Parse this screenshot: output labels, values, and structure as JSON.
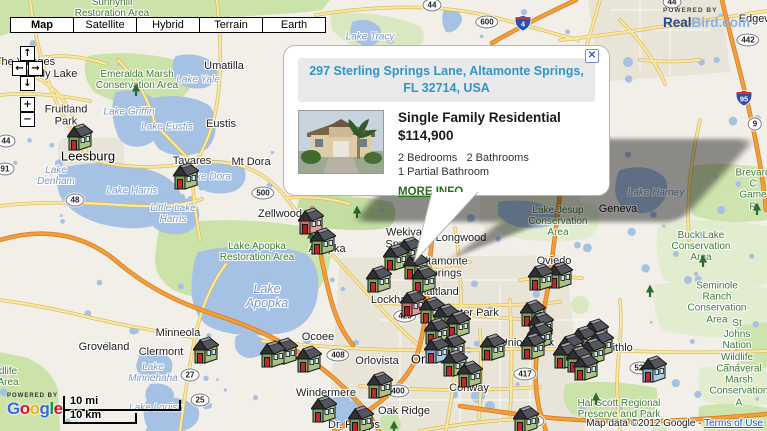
{
  "map_type_bar": {
    "buttons": [
      {
        "label": "Map",
        "active": true
      },
      {
        "label": "Satellite",
        "active": false
      },
      {
        "label": "Hybrid",
        "active": false
      },
      {
        "label": "Terrain",
        "active": false
      },
      {
        "label": "Earth",
        "active": false
      }
    ]
  },
  "pan_zoom": {
    "up": "↑",
    "left": "←",
    "right": "→",
    "down": "↓",
    "zoom_in": "+",
    "zoom_out": "−"
  },
  "branding_realbird": {
    "powered_by": "POWERED BY",
    "name_primary": "Real",
    "name_secondary": "Bird.com"
  },
  "branding_google": {
    "powered_by": "POWERED BY",
    "letters": [
      {
        "ch": "G",
        "color": "#3369e8"
      },
      {
        "ch": "o",
        "color": "#d50f25"
      },
      {
        "ch": "o",
        "color": "#eeb211"
      },
      {
        "ch": "g",
        "color": "#3369e8"
      },
      {
        "ch": "l",
        "color": "#009925"
      },
      {
        "ch": "e",
        "color": "#d50f25"
      }
    ]
  },
  "scale_bar": {
    "miles": "10 mi",
    "km": "10 km"
  },
  "attribution": {
    "text": "Map data ©2012 Google - ",
    "link": "Terms of Use"
  },
  "info_window": {
    "address": "297 Sterling Springs Lane, Altamonte Springs,\nFL 32714, USA",
    "property_type": "Single Family Residential",
    "price": "$114,900",
    "beds": "2 Bedrooms",
    "baths": "2 Bathrooms",
    "partial": "1 Partial Bathroom",
    "more_info": "MORE INFO",
    "close": "✕"
  },
  "colors": {
    "address": "#3096c7",
    "more_info": "#2d6e1f",
    "link": "#1155cc",
    "realbird_primary": "#24479c",
    "realbird_secondary": "#8ab0e0",
    "water": "#a5c1e3",
    "park": "#cbe2a8",
    "road_orange": "#f49d3b",
    "road_yellow": "#f8e9a2"
  },
  "marker_styles": {
    "g": {
      "front": "#7ea357",
      "side": "#a8c483",
      "roofA": "#2f2f35",
      "roofB": "#55555e",
      "door": "#c1272d"
    },
    "p": {
      "front": "#c96d6d",
      "side": "#e49c9c",
      "roofA": "#2f2f35",
      "roofB": "#55555e",
      "door": "#a31d1d"
    },
    "b": {
      "front": "#7fa9cb",
      "side": "#abcde4",
      "roofA": "#2f2f35",
      "roofB": "#55555e",
      "door": "#c1272d"
    }
  },
  "markers": [
    {
      "x": 80,
      "y": 137,
      "c": "g"
    },
    {
      "x": 186,
      "y": 176,
      "c": "g"
    },
    {
      "x": 311,
      "y": 221,
      "c": "p"
    },
    {
      "x": 323,
      "y": 241,
      "c": "g"
    },
    {
      "x": 396,
      "y": 257,
      "c": "g"
    },
    {
      "x": 410,
      "y": 250,
      "c": "g"
    },
    {
      "x": 379,
      "y": 279,
      "c": "g"
    },
    {
      "x": 424,
      "y": 279,
      "c": "g"
    },
    {
      "x": 416,
      "y": 266,
      "c": "g"
    },
    {
      "x": 413,
      "y": 303,
      "c": "p"
    },
    {
      "x": 432,
      "y": 310,
      "c": "g"
    },
    {
      "x": 446,
      "y": 317,
      "c": "g"
    },
    {
      "x": 458,
      "y": 324,
      "c": "g"
    },
    {
      "x": 437,
      "y": 331,
      "c": "g"
    },
    {
      "x": 437,
      "y": 350,
      "c": "b"
    },
    {
      "x": 453,
      "y": 347,
      "c": "g"
    },
    {
      "x": 455,
      "y": 363,
      "c": "g"
    },
    {
      "x": 470,
      "y": 374,
      "c": "g"
    },
    {
      "x": 493,
      "y": 347,
      "c": "g"
    },
    {
      "x": 533,
      "y": 313,
      "c": "g"
    },
    {
      "x": 541,
      "y": 325,
      "c": "g"
    },
    {
      "x": 540,
      "y": 335,
      "c": "g"
    },
    {
      "x": 533,
      "y": 346,
      "c": "g"
    },
    {
      "x": 596,
      "y": 332,
      "c": "g"
    },
    {
      "x": 584,
      "y": 339,
      "c": "g"
    },
    {
      "x": 571,
      "y": 347,
      "c": "g"
    },
    {
      "x": 593,
      "y": 351,
      "c": "g"
    },
    {
      "x": 579,
      "y": 359,
      "c": "g"
    },
    {
      "x": 566,
      "y": 355,
      "c": "g"
    },
    {
      "x": 601,
      "y": 343,
      "c": "g"
    },
    {
      "x": 586,
      "y": 367,
      "c": "g"
    },
    {
      "x": 654,
      "y": 369,
      "c": "b"
    },
    {
      "x": 541,
      "y": 277,
      "c": "g"
    },
    {
      "x": 560,
      "y": 275,
      "c": "g"
    },
    {
      "x": 324,
      "y": 409,
      "c": "g"
    },
    {
      "x": 361,
      "y": 419,
      "c": "g"
    },
    {
      "x": 380,
      "y": 385,
      "c": "g"
    },
    {
      "x": 526,
      "y": 419,
      "c": "g"
    },
    {
      "x": 206,
      "y": 350,
      "c": "g"
    },
    {
      "x": 273,
      "y": 354,
      "c": "g"
    },
    {
      "x": 285,
      "y": 351,
      "c": "g"
    },
    {
      "x": 309,
      "y": 359,
      "c": "g"
    }
  ],
  "labels": [
    {
      "t": "The Villages",
      "x": 25,
      "y": 62,
      "k": "city"
    },
    {
      "t": "Lady Lake",
      "x": 52,
      "y": 74,
      "k": "city"
    },
    {
      "t": "Umatilla",
      "x": 224,
      "y": 66,
      "k": "city"
    },
    {
      "t": "Fruitland\nPark",
      "x": 66,
      "y": 116,
      "k": "city"
    },
    {
      "t": "Eustis",
      "x": 221,
      "y": 124,
      "k": "city"
    },
    {
      "t": "Leesburg",
      "x": 88,
      "y": 157,
      "k": "citylg"
    },
    {
      "t": "Tavares",
      "x": 192,
      "y": 161,
      "k": "city"
    },
    {
      "t": "Mt Dora",
      "x": 251,
      "y": 162,
      "k": "city"
    },
    {
      "t": "Zellwood",
      "x": 280,
      "y": 214,
      "k": "city"
    },
    {
      "t": "Apopka",
      "x": 327,
      "y": 249,
      "k": "city"
    },
    {
      "t": "Wekiva\nSprings",
      "x": 404,
      "y": 239,
      "k": "city"
    },
    {
      "t": "Longwood",
      "x": 461,
      "y": 238,
      "k": "city"
    },
    {
      "t": "Altamonte\nSprings",
      "x": 443,
      "y": 268,
      "k": "city"
    },
    {
      "t": "Maitland",
      "x": 438,
      "y": 292,
      "k": "city"
    },
    {
      "t": "Lockhart",
      "x": 392,
      "y": 300,
      "k": "city"
    },
    {
      "t": "Winter Park",
      "x": 470,
      "y": 313,
      "k": "city"
    },
    {
      "t": "Oviedo",
      "x": 554,
      "y": 261,
      "k": "city"
    },
    {
      "t": "Geneva",
      "x": 618,
      "y": 209,
      "k": "city"
    },
    {
      "t": "Minneola",
      "x": 178,
      "y": 333,
      "k": "city"
    },
    {
      "t": "Groveland",
      "x": 104,
      "y": 347,
      "k": "city"
    },
    {
      "t": "Clermont",
      "x": 161,
      "y": 352,
      "k": "city"
    },
    {
      "t": "Ocoee",
      "x": 318,
      "y": 337,
      "k": "city"
    },
    {
      "t": "Orlovista",
      "x": 377,
      "y": 361,
      "k": "city"
    },
    {
      "t": "Orlando",
      "x": 434,
      "y": 360,
      "k": "citylg"
    },
    {
      "t": "Conway",
      "x": 469,
      "y": 388,
      "k": "city"
    },
    {
      "t": "Union Park",
      "x": 527,
      "y": 343,
      "k": "city"
    },
    {
      "t": "Windermere",
      "x": 326,
      "y": 393,
      "k": "city"
    },
    {
      "t": "Oak Ridge",
      "x": 404,
      "y": 411,
      "k": "city"
    },
    {
      "t": "Dr. Phillips",
      "x": 354,
      "y": 425,
      "k": "city"
    },
    {
      "t": "Bithlo",
      "x": 619,
      "y": 348,
      "k": "city"
    },
    {
      "t": "Edgewater",
      "x": 765,
      "y": 19,
      "k": "city"
    },
    {
      "t": "Lake Yale",
      "x": 198,
      "y": 80,
      "k": "water"
    },
    {
      "t": "Lake Griffin",
      "x": 129,
      "y": 112,
      "k": "water"
    },
    {
      "t": "Lake Eustis",
      "x": 167,
      "y": 127,
      "k": "water"
    },
    {
      "t": "Lake Dora",
      "x": 208,
      "y": 177,
      "k": "water"
    },
    {
      "t": "Lake\nDenham",
      "x": 56,
      "y": 176,
      "k": "water"
    },
    {
      "t": "Lake Harris",
      "x": 132,
      "y": 191,
      "k": "water"
    },
    {
      "t": "Little Lake\nHarris",
      "x": 173,
      "y": 214,
      "k": "water"
    },
    {
      "t": "Lake\nApopka",
      "x": 267,
      "y": 296,
      "k": "waterlg"
    },
    {
      "t": "Lake\nMinnehaha",
      "x": 153,
      "y": 373,
      "k": "water"
    },
    {
      "t": "Lake Louisa",
      "x": 156,
      "y": 408,
      "k": "water"
    },
    {
      "t": "Lake Tracy",
      "x": 370,
      "y": 37,
      "k": "water"
    },
    {
      "t": "Lake Harney",
      "x": 656,
      "y": 193,
      "k": "water"
    },
    {
      "t": "Sunnyhill\nRestoration Area",
      "x": 112,
      "y": 8,
      "k": "park"
    },
    {
      "t": "Emeralda Marsh\nConservation Area",
      "x": 137,
      "y": 80,
      "k": "park"
    },
    {
      "t": "Lake Apopka\nRestoration Area",
      "x": 257,
      "y": 252,
      "k": "park"
    },
    {
      "t": "Lake Jesup\nConservation\nArea",
      "x": 558,
      "y": 222,
      "k": "park"
    },
    {
      "t": "Buck Lake\nConservation\nArea",
      "x": 701,
      "y": 247,
      "k": "park"
    },
    {
      "t": "Seminole Ranch\nConservation Area",
      "x": 717,
      "y": 303,
      "k": "park"
    },
    {
      "t": "St Johns Nation\nWildlife Refug",
      "x": 737,
      "y": 346,
      "k": "park"
    },
    {
      "t": "Canaveral Marsh\nConservation A",
      "x": 739,
      "y": 386,
      "k": "park"
    },
    {
      "t": "Hal Scott Regional\nPreserve and Park",
      "x": 619,
      "y": 409,
      "k": "park"
    },
    {
      "t": "Brevard C\nGame R",
      "x": 753,
      "y": 190,
      "k": "park"
    },
    {
      "t": "dlife\nArea",
      "x": 8,
      "y": 377,
      "k": "park"
    },
    {
      "t": "44",
      "x": 6,
      "y": 141,
      "k": "shield"
    },
    {
      "t": "91",
      "x": 5,
      "y": 169,
      "k": "shield"
    },
    {
      "t": "48",
      "x": 75,
      "y": 200,
      "k": "shield"
    },
    {
      "t": "500",
      "x": 263,
      "y": 193,
      "k": "shield"
    },
    {
      "t": "44",
      "x": 432,
      "y": 5,
      "k": "shield"
    },
    {
      "t": "44",
      "x": 672,
      "y": 2,
      "k": "shield"
    },
    {
      "t": "600",
      "x": 487,
      "y": 22,
      "k": "shield"
    },
    {
      "t": "442",
      "x": 748,
      "y": 40,
      "k": "shield"
    },
    {
      "t": "9",
      "x": 755,
      "y": 124,
      "k": "shield"
    },
    {
      "t": "27",
      "x": 190,
      "y": 375,
      "k": "shield"
    },
    {
      "t": "25",
      "x": 200,
      "y": 400,
      "k": "shield"
    },
    {
      "t": "408",
      "x": 338,
      "y": 355,
      "k": "shield"
    },
    {
      "t": "400",
      "x": 398,
      "y": 391,
      "k": "shield"
    },
    {
      "t": "417",
      "x": 525,
      "y": 374,
      "k": "shield"
    },
    {
      "t": "423",
      "x": 405,
      "y": 316,
      "k": "shield"
    },
    {
      "t": "528",
      "x": 533,
      "y": 421,
      "k": "shield"
    },
    {
      "t": "520",
      "x": 641,
      "y": 368,
      "k": "shield"
    },
    {
      "t": "4",
      "x": 523,
      "y": 23,
      "k": "ishield"
    },
    {
      "t": "95",
      "x": 744,
      "y": 98,
      "k": "ishield"
    },
    {
      "t": "",
      "x": 136,
      "y": 90,
      "k": "tree"
    },
    {
      "t": "",
      "x": 311,
      "y": 237,
      "k": "tree"
    },
    {
      "t": "",
      "x": 357,
      "y": 212,
      "k": "tree"
    },
    {
      "t": "",
      "x": 596,
      "y": 399,
      "k": "tree"
    },
    {
      "t": "",
      "x": 703,
      "y": 261,
      "k": "tree"
    },
    {
      "t": "",
      "x": 650,
      "y": 291,
      "k": "tree"
    },
    {
      "t": "",
      "x": 757,
      "y": 209,
      "k": "tree"
    },
    {
      "t": "",
      "x": 394,
      "y": 427,
      "k": "tree"
    }
  ]
}
